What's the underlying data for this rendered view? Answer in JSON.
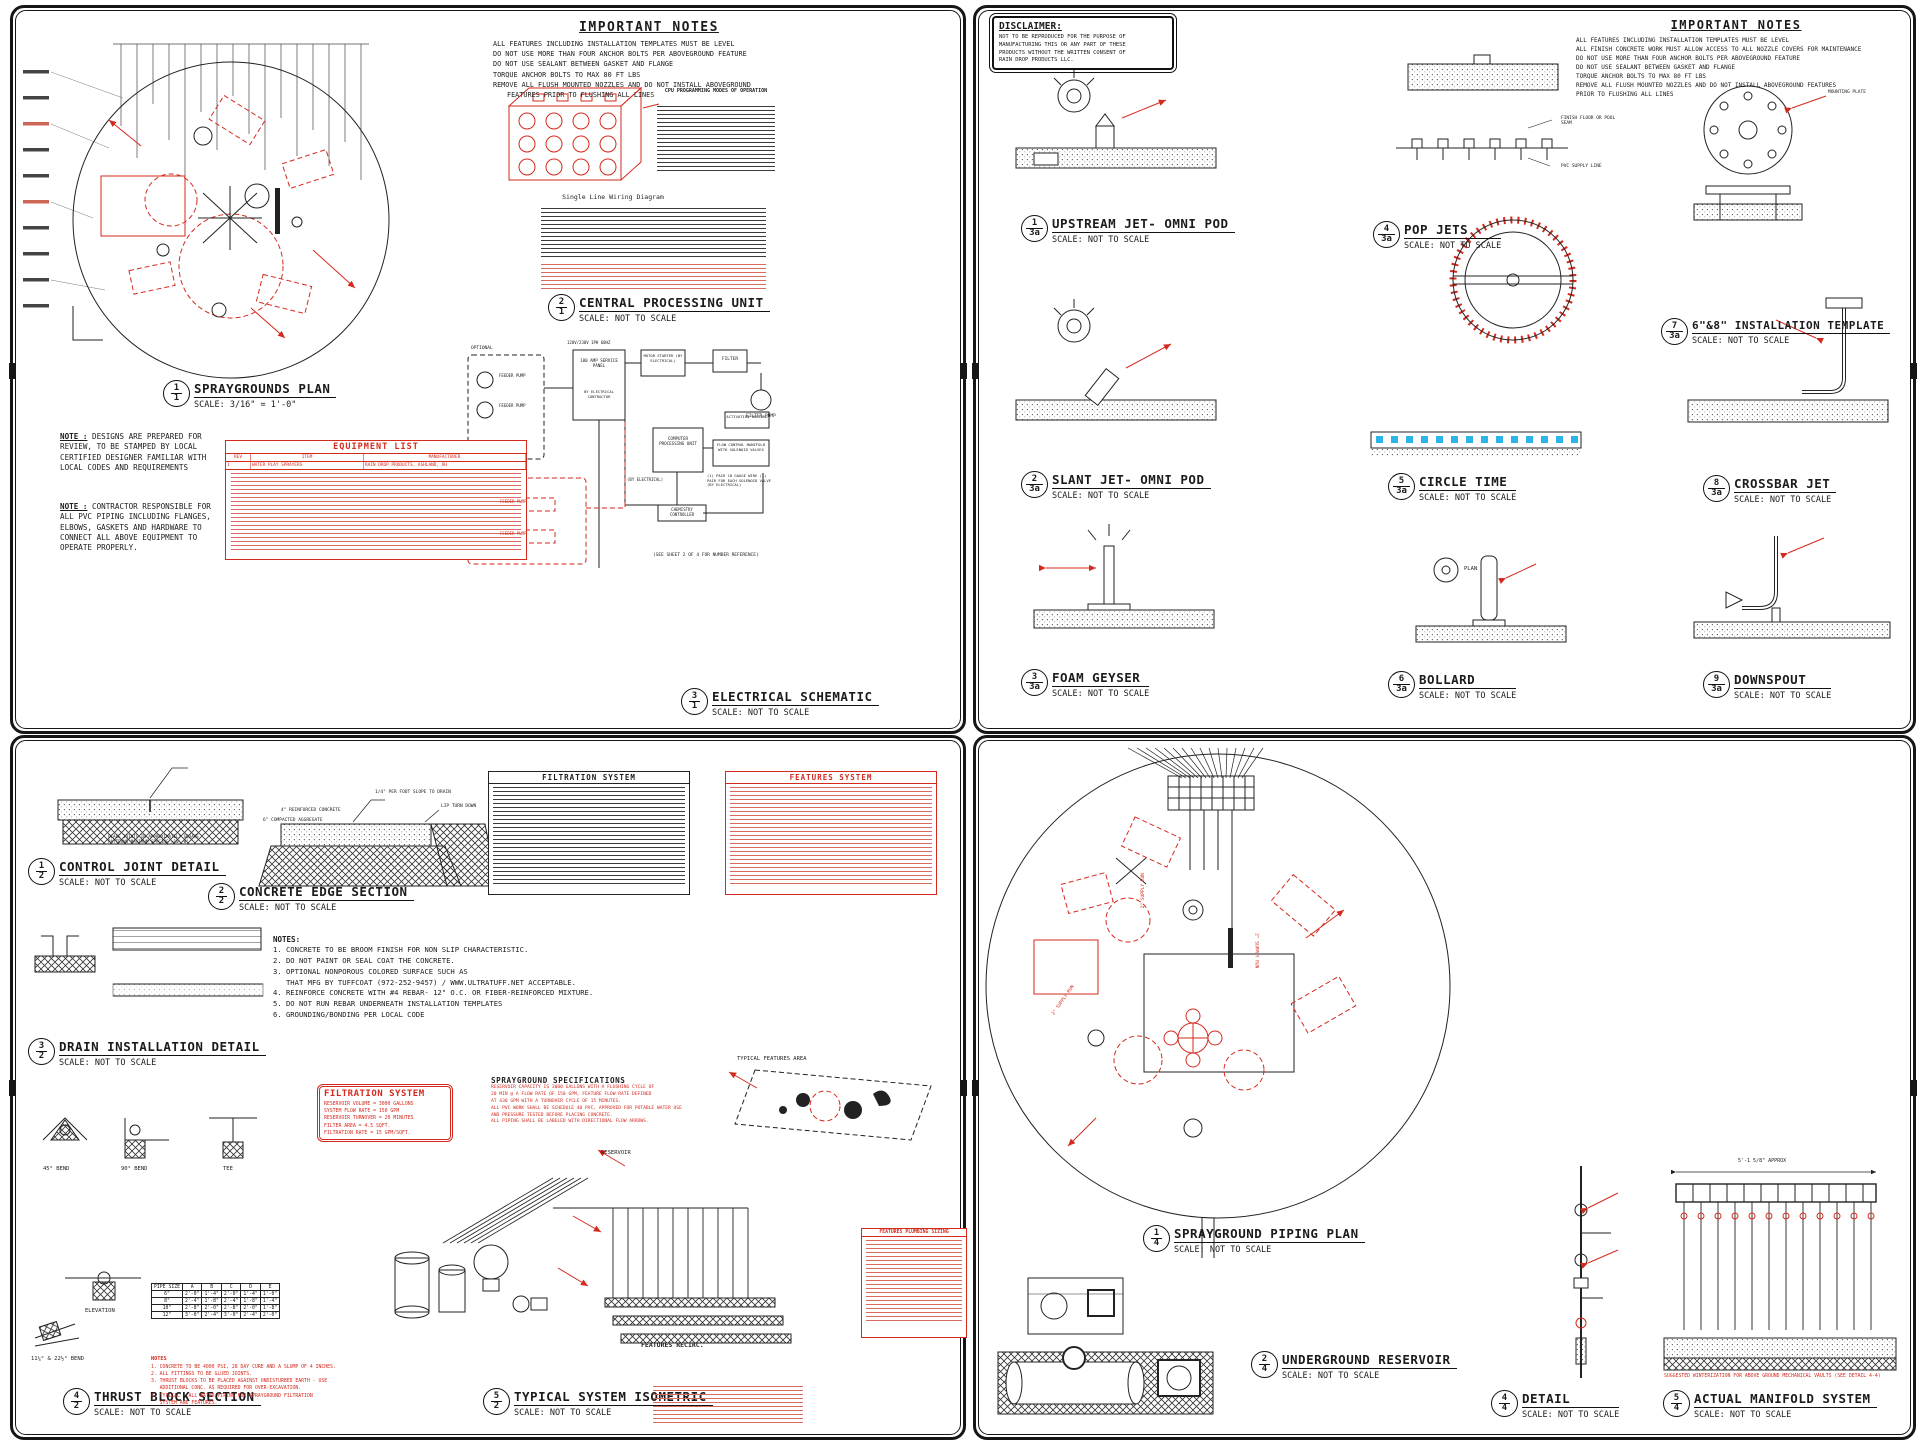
{
  "s1": {
    "important_notes": {
      "title": "IMPORTANT NOTES",
      "lines": [
        "ALL FEATURES INCLUDING INSTALLATION TEMPLATES MUST BE LEVEL",
        "DO NOT USE MORE THAN FOUR ANCHOR BOLTS PER ABOVEGROUND FEATURE",
        "DO NOT USE SEALANT BETWEEN GASKET AND FLANGE",
        "TORQUE ANCHOR BOLTS TO MAX 80 FT LBS",
        "REMOVE ALL FLUSH MOUNTED NOZZLES AND DO NOT INSTALL ABOVEGROUND",
        "FEATURES PRIOR TO FLUSHING ALL LINES"
      ]
    },
    "titles": {
      "plan": {
        "num": "1",
        "ref": "1",
        "name": "SPRAYGROUNDS PLAN",
        "scale": "SCALE: 3/16\" = 1'-0\""
      },
      "cpu": {
        "num": "2",
        "ref": "1",
        "name": "CENTRAL PROCESSING UNIT",
        "scale": "SCALE: NOT TO SCALE"
      },
      "elec": {
        "num": "3",
        "ref": "1",
        "name": "ELECTRICAL SCHEMATIC",
        "scale": "SCALE: NOT TO SCALE"
      }
    },
    "note_design": {
      "label": "NOTE :",
      "text": "DESIGNS ARE PREPARED FOR REVIEW, TO BE STAMPED BY LOCAL CERTIFIED DESIGNER FAMILIAR WITH LOCAL CODES AND REQUIREMENTS"
    },
    "note_contractor": {
      "label": "NOTE :",
      "text": "CONTRACTOR RESPONSIBLE FOR ALL PVC PIPING INCLUDING FLANGES, ELBOWS, GASKETS AND HARDWARE TO CONNECT ALL ABOVE EQUIPMENT TO OPERATE PROPERLY."
    },
    "equipment": {
      "title": "EQUIPMENT LIST",
      "cols": [
        "REV",
        "ITEM",
        "MANUFACTURER"
      ],
      "row1": [
        "1",
        "WATER PLAY SPRAYERS",
        "RAIN DROP PRODUCTS, ASHLAND, OH"
      ]
    },
    "cpu_header": "CPU PROGRAMMING MODES OF OPERATION",
    "wiring_caption": "Single Line Wiring Diagram",
    "elec": {
      "optional": "OPTIONAL",
      "volts": "120V/230V 1PH 60HZ",
      "panel": "100 AMP SERVICE PANEL",
      "byec": "BY ELECTRICAL CONTRACTOR",
      "starter": "MOTOR STARTER (BY ELECTRICAL)",
      "filter": "FILTER",
      "feeder": "FEEDER PUMP",
      "fpump": "FILTER PUMP",
      "cpu": "COMPUTER PROCESSING UNIT",
      "bollard": "ACTIVATION BOLLARD",
      "manifold": "FLOW CONTROL MANIFOLD WITH SOLENOID VALVES",
      "chem": "CHEMISTRY CONTROLLER",
      "byel": "(BY ELECTRICAL)",
      "wire_note": "(1) PAIR 18 GAUGE WIRE (1) PAIR FOR EACH SOLENOID VALVE (BY ELECTRICAL)",
      "see_sheet": "(SEE SHEET 2 OF 4 FOR NUMBER REFERENCE)"
    }
  },
  "s2": {
    "disclaimer": {
      "title": "DISCLAIMER:",
      "lines": [
        "NOT TO BE REPRODUCED FOR THE PURPOSE OF",
        "MANUFACTURING THIS OR ANY PART OF THESE",
        "PRODUCTS WITHOUT THE WRITTEN CONSENT OF",
        "RAIN DROP PRODUCTS LLC."
      ]
    },
    "important_notes": {
      "title": "IMPORTANT NOTES",
      "lines": [
        "ALL FEATURES INCLUDING INSTALLATION TEMPLATES MUST BE LEVEL",
        "ALL FINISH CONCRETE WORK MUST ALLOW ACCESS TO ALL NOZZLE COVERS FOR MAINTENANCE",
        "DO NOT USE MORE THAN FOUR ANCHOR BOLTS PER ABOVEGROUND FEATURE",
        "DO NOT USE SEALANT BETWEEN GASKET AND FLANGE",
        "TORQUE ANCHOR BOLTS TO MAX 80 FT LBS",
        "REMOVE ALL FLUSH MOUNTED NOZZLES AND DO NOT INSTALL ABOVEGROUND FEATURES",
        "PRIOR TO FLUSHING ALL LINES"
      ]
    },
    "titles": {
      "upstream": {
        "num": "1",
        "ref": "3a",
        "name": "UPSTREAM JET- OMNI POD",
        "scale": "SCALE: NOT TO SCALE"
      },
      "popjets": {
        "num": "4",
        "ref": "3a",
        "name": "POP JETS",
        "scale": "SCALE: NOT TO SCALE"
      },
      "template": {
        "num": "7",
        "ref": "3a",
        "name": "6\"&8\" INSTALLATION TEMPLATE",
        "scale": "SCALE: NOT TO SCALE"
      },
      "slant": {
        "num": "2",
        "ref": "3a",
        "name": "SLANT JET- OMNI POD",
        "scale": "SCALE: NOT TO SCALE"
      },
      "circle": {
        "num": "5",
        "ref": "3a",
        "name": "CIRCLE TIME",
        "scale": "SCALE: NOT TO SCALE"
      },
      "crossbar": {
        "num": "8",
        "ref": "3a",
        "name": "CROSSBAR JET",
        "scale": "SCALE: NOT TO SCALE"
      },
      "foam": {
        "num": "3",
        "ref": "3a",
        "name": "FOAM GEYSER",
        "scale": "SCALE: NOT TO SCALE"
      },
      "bollard": {
        "num": "6",
        "ref": "3a",
        "name": "BOLLARD",
        "scale": "SCALE: NOT TO SCALE"
      },
      "downspout": {
        "num": "9",
        "ref": "3a",
        "name": "DOWNSPOUT",
        "scale": "SCALE: NOT TO SCALE"
      }
    },
    "labels": {
      "finish": "FINISH FLOOR OR POOL SEAM",
      "pvc": "PVC SUPPLY LINE",
      "plate": "MOUNTING PLATE",
      "plan": "PLAN"
    }
  },
  "s3": {
    "titles": {
      "control": {
        "num": "1",
        "ref": "2",
        "name": "CONTROL JOINT DETAIL",
        "scale": "SCALE: NOT TO SCALE"
      },
      "edge": {
        "num": "2",
        "ref": "2",
        "name": "CONCRETE EDGE SECTION",
        "scale": "SCALE: NOT TO SCALE"
      },
      "drain": {
        "num": "3",
        "ref": "2",
        "name": "DRAIN INSTALLATION DETAIL",
        "scale": "SCALE: NOT TO SCALE"
      },
      "thrust": {
        "num": "4",
        "ref": "2",
        "name": "THRUST BLOCK SECTION",
        "scale": "SCALE: NOT TO SCALE"
      },
      "iso": {
        "num": "5",
        "ref": "2",
        "name": "TYPICAL SYSTEM ISOMETRIC",
        "scale": "SCALE: NOT TO SCALE"
      }
    },
    "notes": {
      "title": "NOTES:",
      "lines": [
        "1. CONCRETE TO BE BROOM FINISH FOR NON SLIP CHARACTERISTIC.",
        "2. DO NOT PAINT OR SEAL COAT THE CONCRETE.",
        "3. OPTIONAL NONPOROUS COLORED SURFACE SUCH AS",
        "   THAT MFG BY TUFFCOAT (972-252-9457) / WWW.ULTRATUFF.NET ACCEPTABLE.",
        "4. REINFORCE CONCRETE WITH #4 REBAR- 12\" O.C. OR FIBER-REINFORCED MIXTURE.",
        "5. DO NOT RUN REBAR UNDERNEATH INSTALLATION TEMPLATES",
        "6. GROUNDING/BONDING PER LOCAL CODE"
      ]
    },
    "tables": {
      "filtration": {
        "title": "FILTRATION SYSTEM"
      },
      "features": {
        "title": "FEATURES SYSTEM"
      },
      "fps": {
        "title": "FEATURES PLUMBING SIZING"
      }
    },
    "filtration_box": {
      "title": "FILTRATION SYSTEM",
      "lines": [
        "RESERVOIR VOLUME = 3000 GALLONS",
        "SYSTEM FLOW RATE = 150 GPM",
        "RESERVOIR TURNOVER = 20 MINUTES",
        "FILTER AREA = 4.5 SQFT.",
        "FILTRATION RATE = 15 GPM/SQFT."
      ]
    },
    "specs": {
      "title": "SPRAYGROUND SPECIFICATIONS",
      "lines": [
        "RESERVOIR CAPACITY IS 3000 GALLONS WITH A FLUSHING CYCLE OF",
        "20 MIN @ A FLOW RATE OF 150 GPM, FEATURE FLOW RATE DEFINED",
        "AT 430 GPM WITH A TURNOVER CYCLE OF 15 MINUTES.",
        "ALL PVC WORK SHALL BE SCHEDULE 40 PVC, APPROVED FOR POTABLE WATER USE",
        "AND PRESSURE TESTED BEFORE PLACING CONCRETE.",
        "ALL PIPING SHALL BE LABELED WITH DIRECTIONAL FLOW ARROWS."
      ]
    },
    "thrust_notes": {
      "title": "NOTES",
      "lines": [
        "1. CONCRETE TO BE 4000 PSI, 28 DAY CURE AND A SLUMP OF 4 INCHES.",
        "2. ALL FITTINGS TO BE GLUED JOINTS.",
        "3. THRUST BLOCKS TO BE PLACED AGAINST UNDISTURBED EARTH - USE",
        "   ADDITIONAL CONC. AS REQUIRED FOR OVER-EXCAVATION.",
        "4. TYPICAL - ALL WATER PIPING FOR SPRAYGROUND FILTRATION",
        "   SYSTEM AND FEATURES."
      ]
    },
    "pipe_table": {
      "headers": [
        "PIPE SIZE",
        "A",
        "B",
        "C",
        "D",
        "E"
      ],
      "rows": [
        [
          "6\"",
          "2'-0\"",
          "1'-4\"",
          "2'-0\"",
          "1'-4\"",
          "1'-0\""
        ],
        [
          "8\"",
          "2'-4\"",
          "1'-8\"",
          "2'-4\"",
          "1'-8\"",
          "1'-4\""
        ],
        [
          "10\"",
          "2'-8\"",
          "2'-0\"",
          "2'-8\"",
          "2'-0\"",
          "1'-8\""
        ],
        [
          "12\"",
          "3'-0\"",
          "2'-4\"",
          "3'-0\"",
          "2'-4\"",
          "2'-0\""
        ]
      ]
    },
    "labels": {
      "tfa": "TYPICAL FEATURES AREA",
      "reservoir": "RESERVOIR",
      "recirc": "FEATURES RECIRC.",
      "elevation": "ELEVATION",
      "b45": "45° BEND",
      "b90": "90° BEND",
      "tee": "TEE",
      "b11": "11¼° & 22½° BEND",
      "joints": "PLACE JOINTS IN APPROXIMATELY SQUARE PATTERNS MAXIMUM SPACING =10'-0\"",
      "slope": "1/4\" PER FOOT SLOPE TO DRAIN",
      "lip": "LIP TURN DOWN",
      "conc4": "4\" REINFORCED CONCRETE",
      "agg": "6\" COMPACTED AGGREGATE"
    }
  },
  "s4": {
    "titles": {
      "piping": {
        "num": "1",
        "ref": "4",
        "name": "SPRAYGROUND PIPING PLAN",
        "scale": "SCALE: NOT TO SCALE"
      },
      "reservoir": {
        "num": "2",
        "ref": "4",
        "name": "UNDERGROUND RESERVOIR",
        "scale": "SCALE: NOT TO SCALE"
      },
      "detail": {
        "num": "4",
        "ref": "4",
        "name": "DETAIL",
        "scale": "SCALE: NOT TO SCALE"
      },
      "manifold": {
        "num": "5",
        "ref": "4",
        "name": "ACTUAL MANIFOLD SYSTEM",
        "scale": "SCALE: NOT TO SCALE"
      }
    },
    "labels": {
      "supply": "2\" SUPPLY RUN",
      "approx": "5'-1 5/8\" APPROX",
      "winter": "SUGGESTED WINTERIZATION FOR ABOVE GROUND MECHANICAL VAULTS (SEE DETAIL 4-4)"
    }
  }
}
